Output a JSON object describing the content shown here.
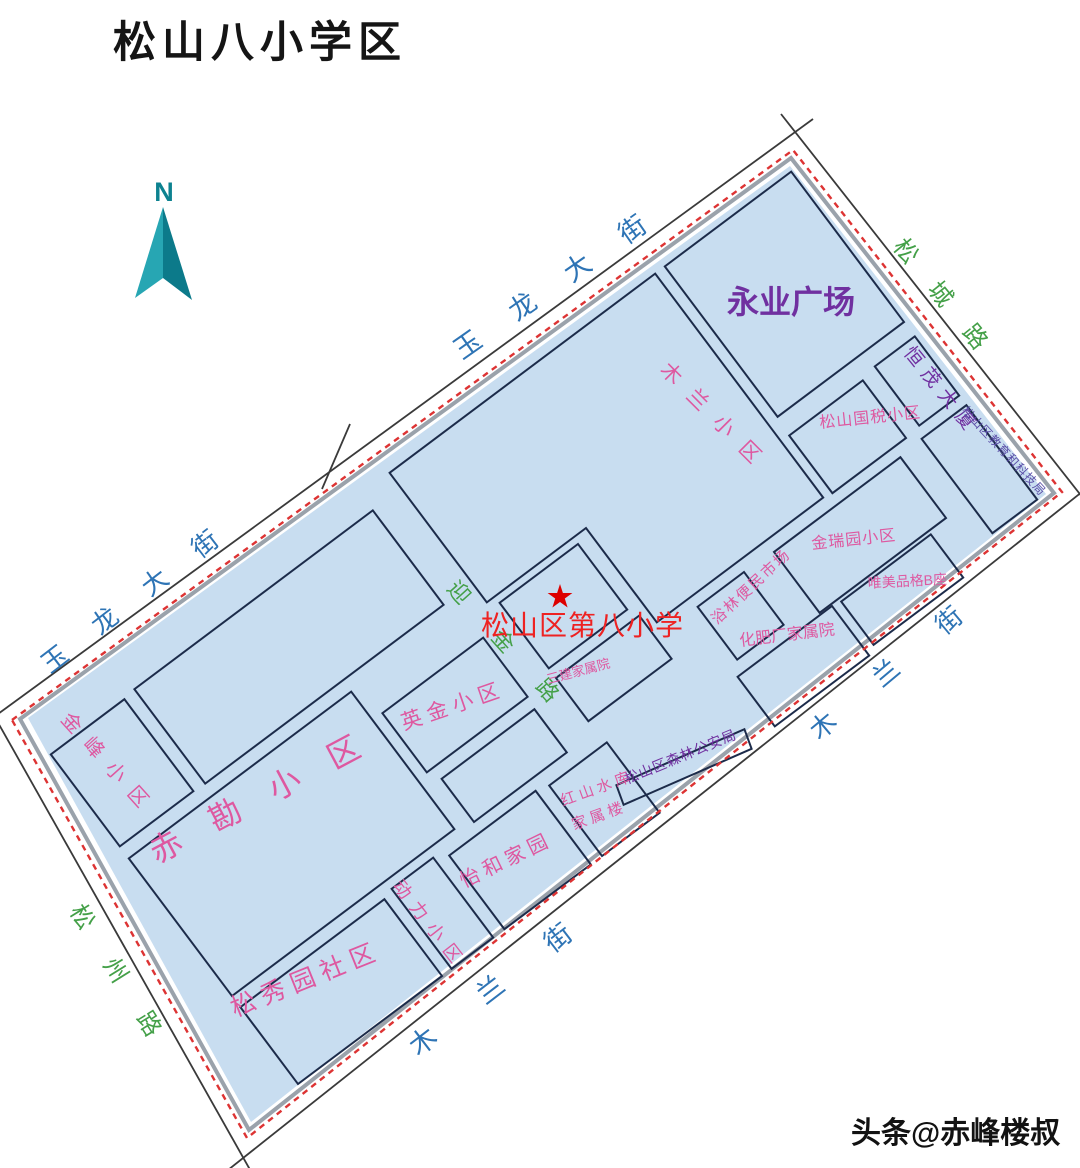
{
  "page": {
    "title": "松山八小学区",
    "watermark": "头条@赤峰楼叔"
  },
  "compass": {
    "label": "N"
  },
  "streets": {
    "yulong_upper": "玉龙大街",
    "yulong_lower": "玉龙大街",
    "songcheng": "松城路",
    "mulan_right": "木兰街",
    "mulan_bottom": "木兰街",
    "songzhou": "松州路",
    "yingjin": "迎金路"
  },
  "school": {
    "name": "松山区第八小学"
  },
  "places": {
    "yongye": "永业广场",
    "hengmao": "恒茂大厦",
    "guoshui": "松山国税小区",
    "jiaokeju": "松山区教育和科技局",
    "jinruiyuan": "金瑞园小区",
    "yulin": "浴林便民市场",
    "demei": "唯美品格B座",
    "huafei": "化肥厂家属院",
    "mulan_xiaoqu": "木兰小区",
    "sanjian": "三建家属院",
    "senlin": "松山区森林公安局",
    "hongshan_line1": "红山水库",
    "hongshan_line2": "家属楼",
    "yingjin_xiaoqu": "英金小区",
    "yihe": "怡和家园",
    "dongli": "动力小区",
    "songxiuyuan": "松秀园社区",
    "chikan": "赤勘小区",
    "jinfeng": "金峰小区"
  },
  "colors": {
    "map_fill": "#c8ddf0",
    "block_outline": "#1c2b4a",
    "boundary_red": "#dd3333",
    "street_blue": "#2e74b5",
    "street_green": "#44a048",
    "place_pink": "#de58a0",
    "place_purple": "#7030a0",
    "edu_bureau_violet": "#5b4fa8",
    "school_red": "#ee2222",
    "compass_teal_light": "#27a6b3",
    "compass_teal_dark": "#0c7a8a",
    "title_black": "#151515"
  }
}
